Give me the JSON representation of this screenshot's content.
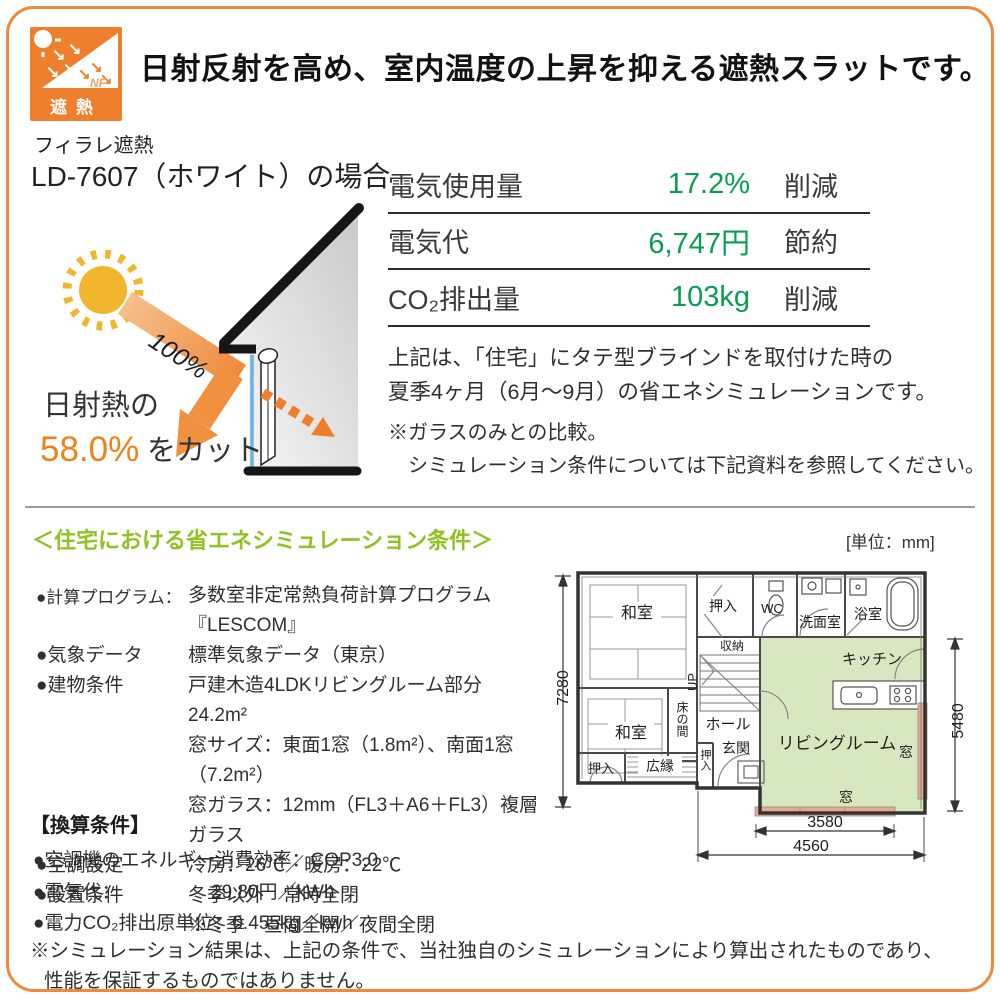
{
  "header": {
    "title": "日射反射を高め、室内温度の上昇を抑える遮熱スラットです。",
    "badge": {
      "nf": "NF",
      "label": "遮熱"
    }
  },
  "hero": {
    "product_series": "フィラレ遮熱",
    "product_model": "LD-7607（ホワイト）の場合",
    "diagram": {
      "incoming": "100%",
      "cut_prefix": "日射熱の",
      "cut_value": "58.0%",
      "cut_suffix": "をカット"
    },
    "stats": [
      {
        "label": "電気使用量",
        "value": "17.2%",
        "suffix": "削減"
      },
      {
        "label": "電気代",
        "value": "6,747円",
        "suffix": "節約"
      },
      {
        "label": "CO₂排出量",
        "value": "103kg",
        "suffix": "削減"
      }
    ],
    "summary_line1": "上記は、「住宅」にタテ型ブラインドを取付けた時の",
    "summary_line2": "夏季4ヶ月（6月～9月）の省エネシミュレーションです。",
    "note_line1": "※ガラスのみとの比較。",
    "note_line2": "シミュレーション条件については下記資料を参照してください。"
  },
  "conditions": {
    "heading": "＜住宅における省エネシミュレーション条件＞",
    "unit": "[単位：mm]",
    "items": [
      {
        "label": "●計算プログラム：",
        "lines": [
          "多数室非定常熱負荷計算プログラム『LESCOM』"
        ]
      },
      {
        "label": "●気象データ",
        "lines": [
          "標準気象データ（東京）"
        ]
      },
      {
        "label": "●建物条件",
        "lines": [
          "戸建木造4LDKリビングルーム部分　24.2m²",
          "窓サイズ：東面1窓（1.8m²）、南面1窓（7.2m²）",
          "窓ガラス：12mm（FL3＋A6＋FL3）複層ガラス"
        ]
      },
      {
        "label": "●空調設定",
        "lines": [
          "冷房：26℃／暖房：22℃"
        ]
      },
      {
        "label": "●設置条件",
        "lines": [
          "冬季以外　常時全閉",
          "※冬季　昼間全開／夜間全閉"
        ]
      }
    ]
  },
  "floorplan": {
    "dims": {
      "left": "7280",
      "right": "5480",
      "window": "3580",
      "total": "4560"
    },
    "rooms": {
      "washitsu1": "和室",
      "washitsu2": "和室",
      "oshiire_top": "押入",
      "wc": "WC",
      "senmenshitsu": "洗面室",
      "yokushitsu": "浴室",
      "shuno": "収納",
      "up": "UP",
      "hall": "ホール",
      "tokonoma": "床の間",
      "genkan": "玄関",
      "oshiire_left": "押入",
      "hiroen": "広縁",
      "oshiire_right": "押入",
      "kitchen": "キッチン",
      "living": "リビングルーム",
      "window_right": "窓",
      "window_bottom": "窓"
    }
  },
  "conversion": {
    "heading": "【換算条件】",
    "items": [
      {
        "label": "●空調機のエネルギー消費効率：",
        "value": "COP3.0"
      },
      {
        "label": "●電気代：",
        "value": "29.80円／kWh"
      },
      {
        "label": "●電力CO₂排出原単位：",
        "value": "0.455kg／kwh"
      }
    ]
  },
  "disclaimer": {
    "line1": "※シミュレーション結果は、上記の条件で、当社独自のシミュレーションにより算出されたものであり、",
    "line2": "性能を保証するものではありません。"
  },
  "colors": {
    "accent_orange": "#ef8a3c",
    "value_green": "#0a9d51",
    "heading_green": "#8fc322",
    "plan_room_green": "#d7e8c0",
    "plan_window_pink": "#eba88e"
  }
}
